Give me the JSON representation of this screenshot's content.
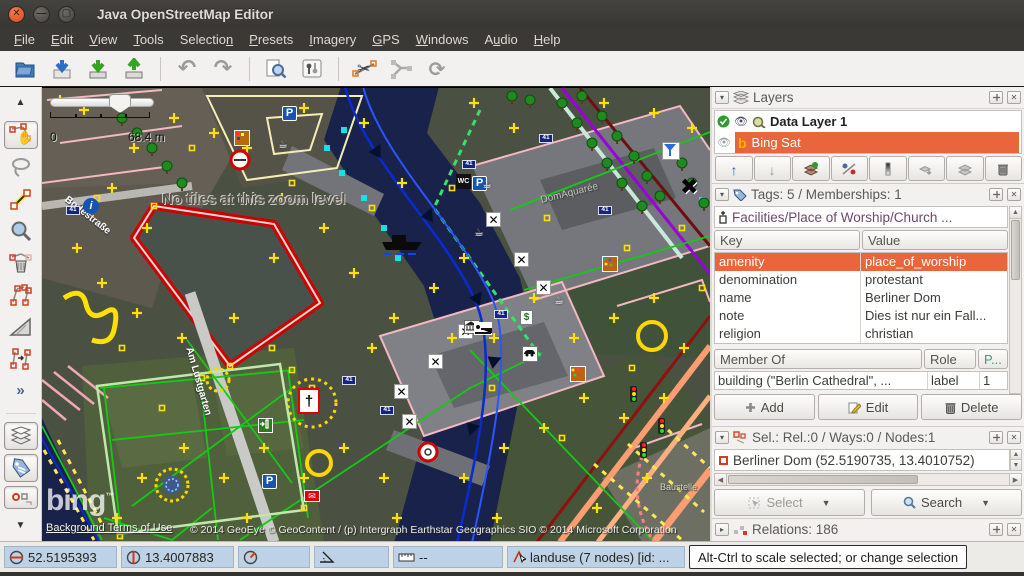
{
  "window": {
    "title": "Java OpenStreetMap Editor"
  },
  "menu": {
    "items": [
      {
        "label": "File",
        "u": 0
      },
      {
        "label": "Edit",
        "u": 0
      },
      {
        "label": "View",
        "u": 0
      },
      {
        "label": "Tools",
        "u": 0
      },
      {
        "label": "Selection",
        "u": 8
      },
      {
        "label": "Presets",
        "u": 0
      },
      {
        "label": "Imagery",
        "u": 0
      },
      {
        "label": "GPS",
        "u": 0
      },
      {
        "label": "Windows",
        "u": 0
      },
      {
        "label": "Audio",
        "u": 1
      },
      {
        "label": "Help",
        "u": 0
      }
    ]
  },
  "toolbar": {
    "icons": [
      "open",
      "download-data",
      "save",
      "upload-data",
      "undo",
      "redo",
      "search-presets",
      "preferences",
      "split-way",
      "combine-way",
      "update-data"
    ]
  },
  "side_toolbar": {
    "icons": [
      "scroll-up",
      "select-tool",
      "lasso-tool",
      "draw-nodes-tool",
      "zoom-tool",
      "delete-tool",
      "unglue-tool",
      "extrude-tool",
      "parallel-tool",
      "more-tools",
      "layers-toggle",
      "tags-toggle",
      "selection-toggle",
      "scroll-down"
    ]
  },
  "map": {
    "scale": {
      "min": "0",
      "max": "68.4 m"
    },
    "no_tiles_message": "No tiles at this zoom level",
    "bing_logo": "bing",
    "terms": "Background Terms of Use",
    "copyright": "© 2014 GeoEye © GeoContent / (p) Intergraph Earthstar Geographics SIO © 2014 Microsoft Corporation",
    "labels": {
      "street_bodestrasse": "Bodestraße",
      "street_am_lustgarten": "Am Lustgarten",
      "area_domaquaree": "DomAquarée",
      "area_baustelle": "Baustelle"
    }
  },
  "layers_panel": {
    "title": "Layers",
    "rows": [
      {
        "name": "Data Layer 1",
        "active": true,
        "selected": false
      },
      {
        "name": "Bing Sat",
        "active": false,
        "selected": true
      }
    ],
    "buttons": [
      "move-layer-up",
      "move-layer-down",
      "merge-layer",
      "toggle-visibility",
      "opacity",
      "duplicate-layer",
      "merge-down",
      "delete-layer"
    ]
  },
  "tags_panel": {
    "title": "Tags: 5 / Memberships: 1",
    "preset": "Facilities/Place of Worship/Church ...",
    "columns": [
      "Key",
      "Value"
    ],
    "rows": [
      [
        "amenity",
        "place_of_worship"
      ],
      [
        "denomination",
        "protestant"
      ],
      [
        "name",
        "Berliner Dom"
      ],
      [
        "note",
        "Dies ist nur ein Fall..."
      ],
      [
        "religion",
        "christian"
      ]
    ],
    "selected_row": 0,
    "member_columns": [
      "Member Of",
      "Role",
      "P..."
    ],
    "member_row": [
      "building (\"Berlin Cathedral\", ...",
      "label",
      "1"
    ],
    "buttons": {
      "add": "Add",
      "edit": "Edit",
      "delete": "Delete"
    }
  },
  "selection_panel": {
    "title": "Sel.: Rel.:0 / Ways:0 / Nodes:1",
    "items": [
      "Berliner Dom (52.5190735, 13.4010752)"
    ],
    "buttons": {
      "select": "Select",
      "search": "Search"
    }
  },
  "relations_panel": {
    "title": "Relations: 186"
  },
  "status_bar": {
    "lat": "52.5195393",
    "lon": "13.4007883",
    "heading": "",
    "angle": "",
    "distance": "--",
    "object_info": "landuse (7 nodes) [id: ...",
    "help": "Alt-Ctrl to scale selected; or change selection"
  },
  "colors": {
    "selection_orange": "#e9653b",
    "chrome_dark": "#3b3935",
    "panel_bg": "#f2f1ef",
    "status_segment_blue": "#bdd1e7",
    "selected_way_red": "#d00000",
    "gps_marker_yellow": "#ffe000"
  }
}
